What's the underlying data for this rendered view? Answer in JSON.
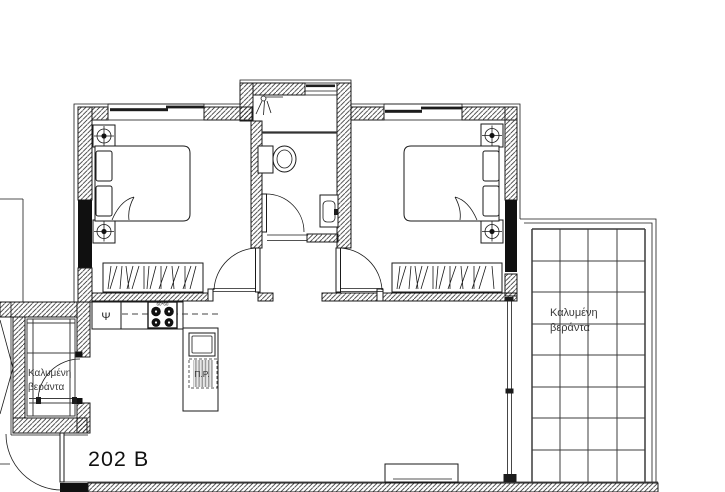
{
  "plan": {
    "unit_label": "202 B",
    "veranda_left": {
      "label_line1": "Καλυμένη",
      "label_line2": "βεράντα"
    },
    "veranda_right": {
      "label_line1": "Καλυμένη",
      "label_line2": "βεράντα"
    },
    "kitchen": {
      "fridge_label": "Ψ",
      "stove_label": "60*60",
      "washer_label": "Π.Ρ."
    },
    "colors": {
      "background": "#ffffff",
      "line": "#1a1a1a",
      "wall_solid": "#101010",
      "tile_grid": "#3c3c3c",
      "label_text": "#3a3a3a"
    }
  }
}
